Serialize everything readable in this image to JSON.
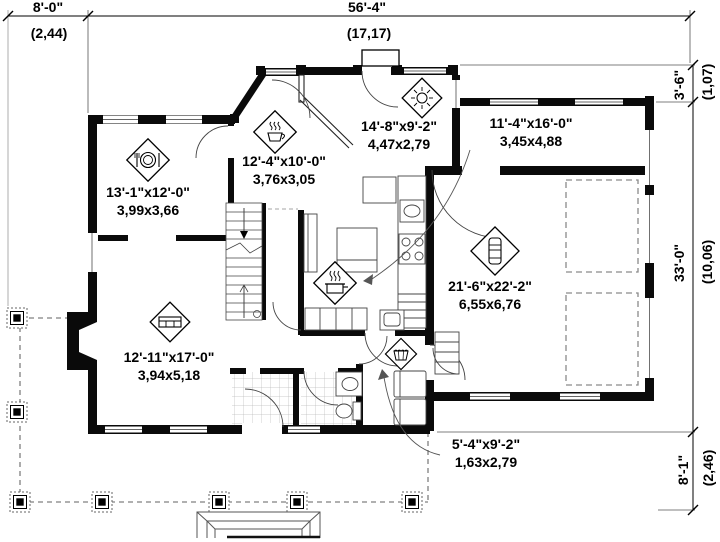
{
  "title": "First floor plan",
  "colors": {
    "wall": "#0a0a0a",
    "line": "#333333",
    "dash": "#808080",
    "bg": "#ffffff"
  },
  "dimensions": {
    "top_left": {
      "feet": "8'-0\"",
      "meters": "(2,44)"
    },
    "top_center": {
      "feet": "56'-4\"",
      "meters": "(17,17)"
    },
    "right_top": {
      "feet": "3'-6\"",
      "meters": "(1,07)"
    },
    "right_mid": {
      "feet": "33'-0\"",
      "meters": "(10,06)"
    },
    "right_bot": {
      "feet": "8'-1\"",
      "meters": "(2,46)"
    }
  },
  "rooms": [
    {
      "id": "dining",
      "icon": "dining-icon",
      "feet": "13'-1\"x12'-0\"",
      "meters": "3,99x3,66"
    },
    {
      "id": "breakfast",
      "icon": "coffee-icon",
      "feet": "12'-4\"x10'-0\"",
      "meters": "3,76x3,05"
    },
    {
      "id": "sunroom",
      "icon": "sun-icon",
      "feet": "14'-8\"x9'-2\"",
      "meters": "4,47x2,79"
    },
    {
      "id": "upper-right",
      "icon": "",
      "feet": "11'-4\"x16'-0\"",
      "meters": "3,45x4,88"
    },
    {
      "id": "garage",
      "icon": "car-icon",
      "feet": "21'-6\"x22'-2\"",
      "meters": "6,55x6,76"
    },
    {
      "id": "living",
      "icon": "sofa-icon",
      "feet": "12'-11\"x17'-0\"",
      "meters": "3,94x5,18"
    },
    {
      "id": "laundry",
      "icon": "basket-icon",
      "feet": "5'-4\"x9'-2\"",
      "meters": "1,63x2,79"
    },
    {
      "id": "kitchen",
      "icon": "cooking-icon",
      "feet": "",
      "meters": ""
    }
  ]
}
